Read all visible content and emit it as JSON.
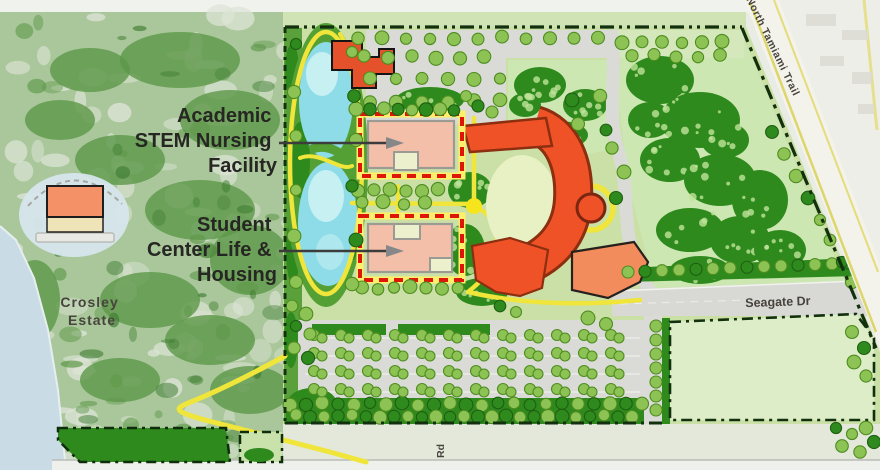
{
  "map": {
    "title": "Campus master plan with Crosley Estate",
    "annotations": {
      "academic_facility": {
        "lines": [
          "Academic",
          "STEM Nursing",
          "Facility"
        ]
      },
      "student_center": {
        "lines": [
          "Student",
          "Center Life &",
          "Housing"
        ]
      },
      "crosley_estate": {
        "lines": [
          "Crosley",
          "Estate"
        ]
      }
    },
    "roads": {
      "seagate": "Seagate Dr",
      "tamiami": "North Tamiami Trail",
      "rd": "Rd"
    },
    "colors": {
      "highlight_box": "#dd1607",
      "highlight_building": "#f4bfa9",
      "campus_building": "#ef5226",
      "building_outline": "#8c2e10",
      "water": "#8edce8",
      "bay_water": "#c9dbe4",
      "field": "#dcedc8",
      "forest": "#2f8a1d",
      "tree_light": "#8dc355",
      "path_yellow": "#f0e53a",
      "parking_gray": "#dadbd7",
      "aerial_green": "#a9c79a",
      "boundary": "#12300e"
    }
  }
}
